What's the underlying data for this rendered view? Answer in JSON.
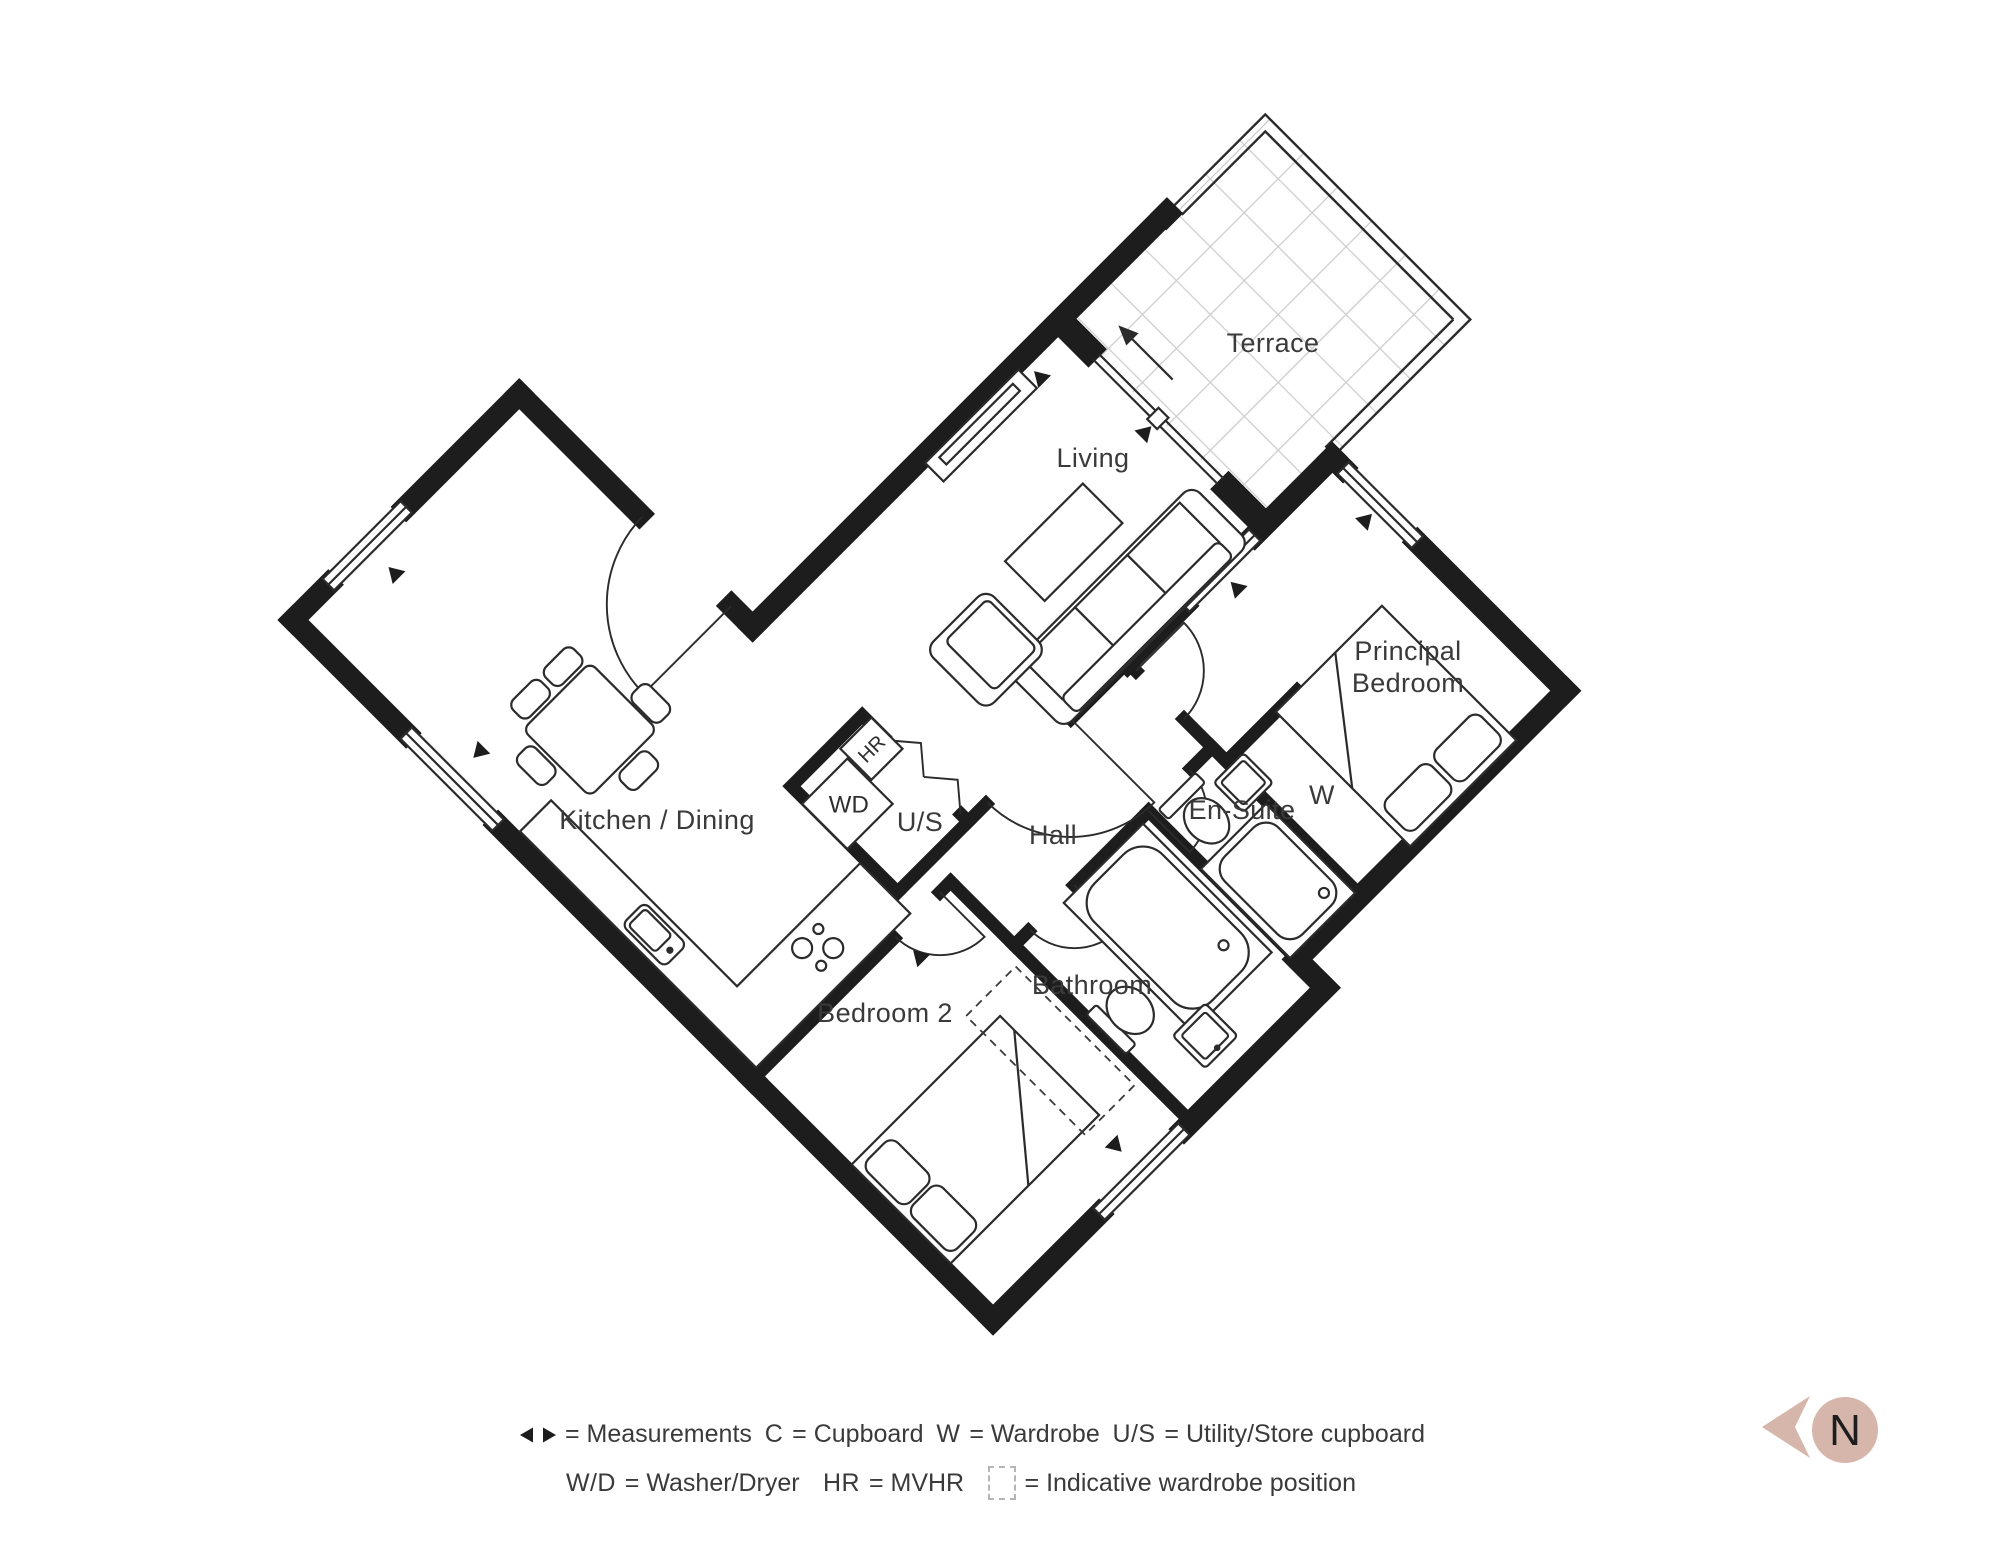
{
  "plan": {
    "rooms": {
      "terrace": "Terrace",
      "living": "Living",
      "principal_bedroom_line1": "Principal",
      "principal_bedroom_line2": "Bedroom",
      "kitchen_dining": "Kitchen / Dining",
      "hall": "Hall",
      "us": "U/S",
      "en_suite": "En-Suite",
      "wardrobe": "W",
      "bathroom": "Bathroom",
      "bedroom2": "Bedroom 2",
      "wd_box": "WD",
      "hr_box": "HR"
    }
  },
  "legend": {
    "row1": [
      {
        "key": "",
        "text": "= Measurements"
      },
      {
        "key": "C",
        "text": "= Cupboard"
      },
      {
        "key": "W",
        "text": "= Wardrobe"
      },
      {
        "key": "U/S",
        "text": "= Utility/Store cupboard"
      }
    ],
    "row2": [
      {
        "key": "W/D",
        "text": "= Washer/Dryer"
      },
      {
        "key": "HR",
        "text": "= MVHR"
      },
      {
        "key": "",
        "text": "= Indicative wardrobe position"
      }
    ]
  },
  "compass": {
    "label": "N"
  },
  "colors": {
    "wall": "#1d1d1d",
    "furniture_line": "#2b2b2b",
    "tile_grid": "#cccccc",
    "label_text": "#3a3a3a",
    "compass_pink": "#d6b6ab"
  }
}
